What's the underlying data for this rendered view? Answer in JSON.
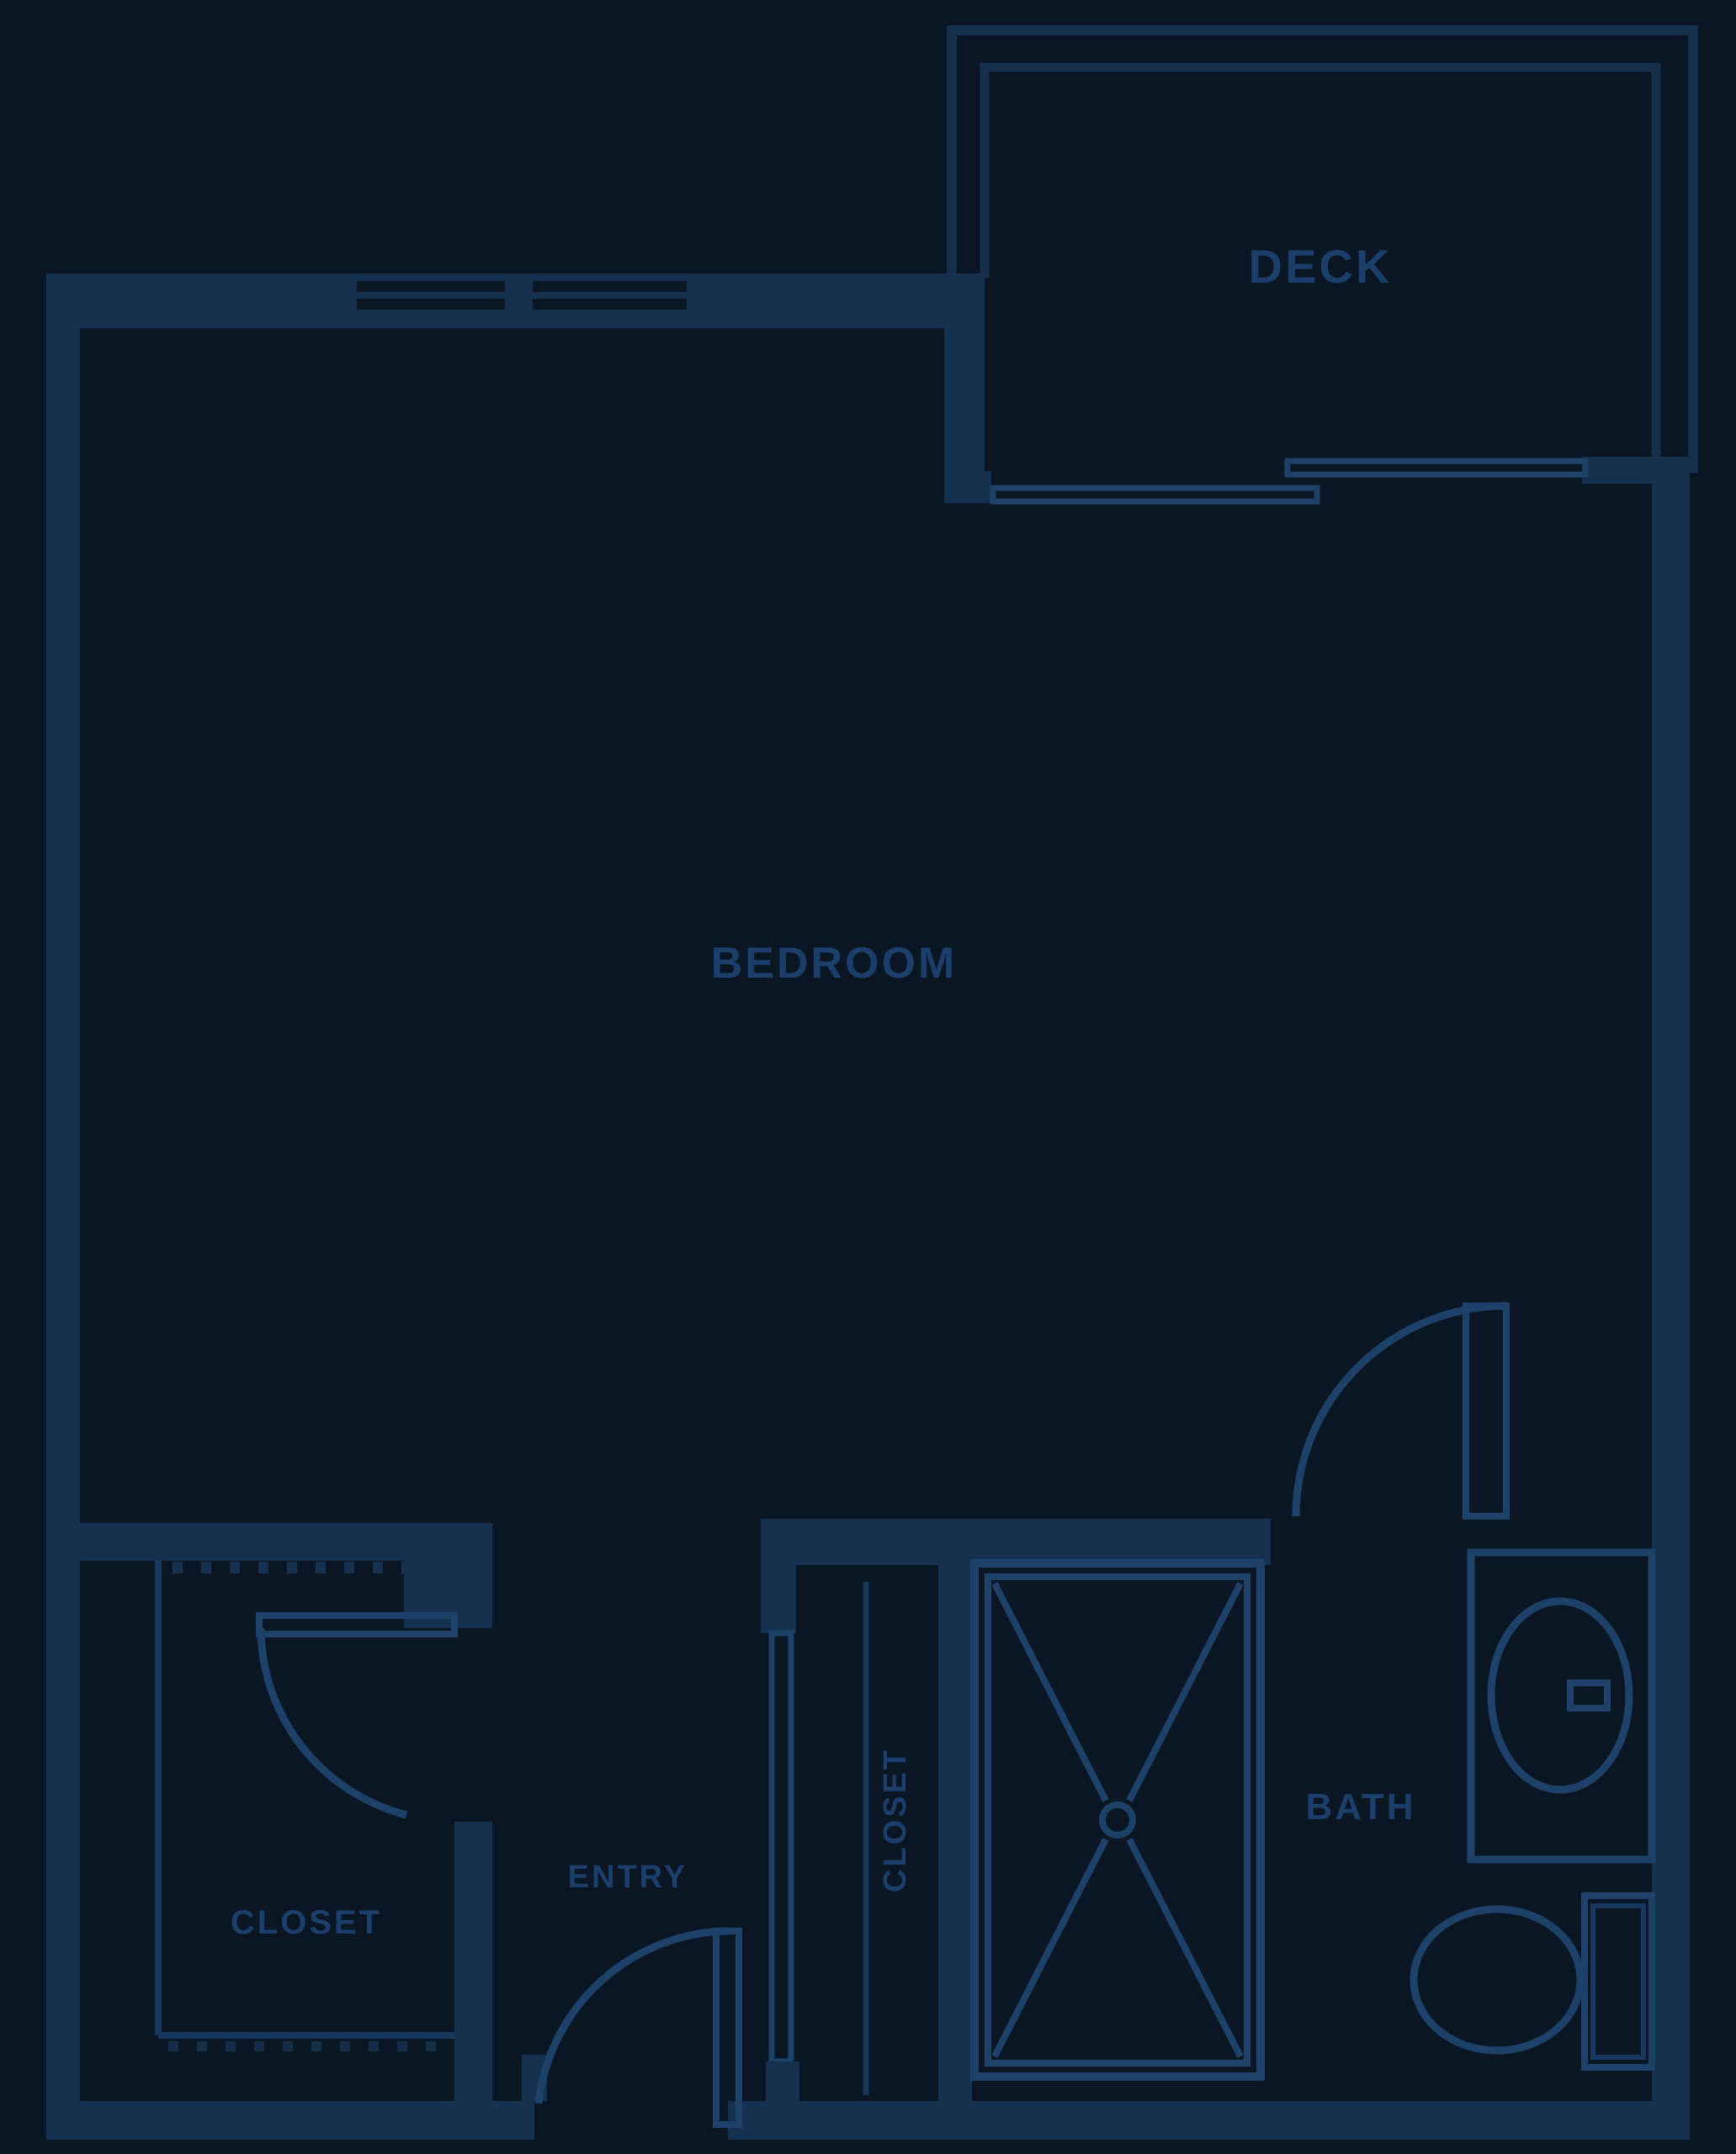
{
  "colors": {
    "background": "#0a1624",
    "wall": "#15314f",
    "line": "#1d4168",
    "line_dim": "#17375c",
    "railing": "#142e4c",
    "label_text": "#1c3e6a"
  },
  "rooms": {
    "deck": {
      "label": "DECK"
    },
    "bedroom": {
      "label": "BEDROOM"
    },
    "closet_main": {
      "label": "CLOSET"
    },
    "entry": {
      "label": "ENTRY"
    },
    "closet_hall": {
      "label": "CLOSET"
    },
    "bath": {
      "label": "BATH"
    }
  }
}
